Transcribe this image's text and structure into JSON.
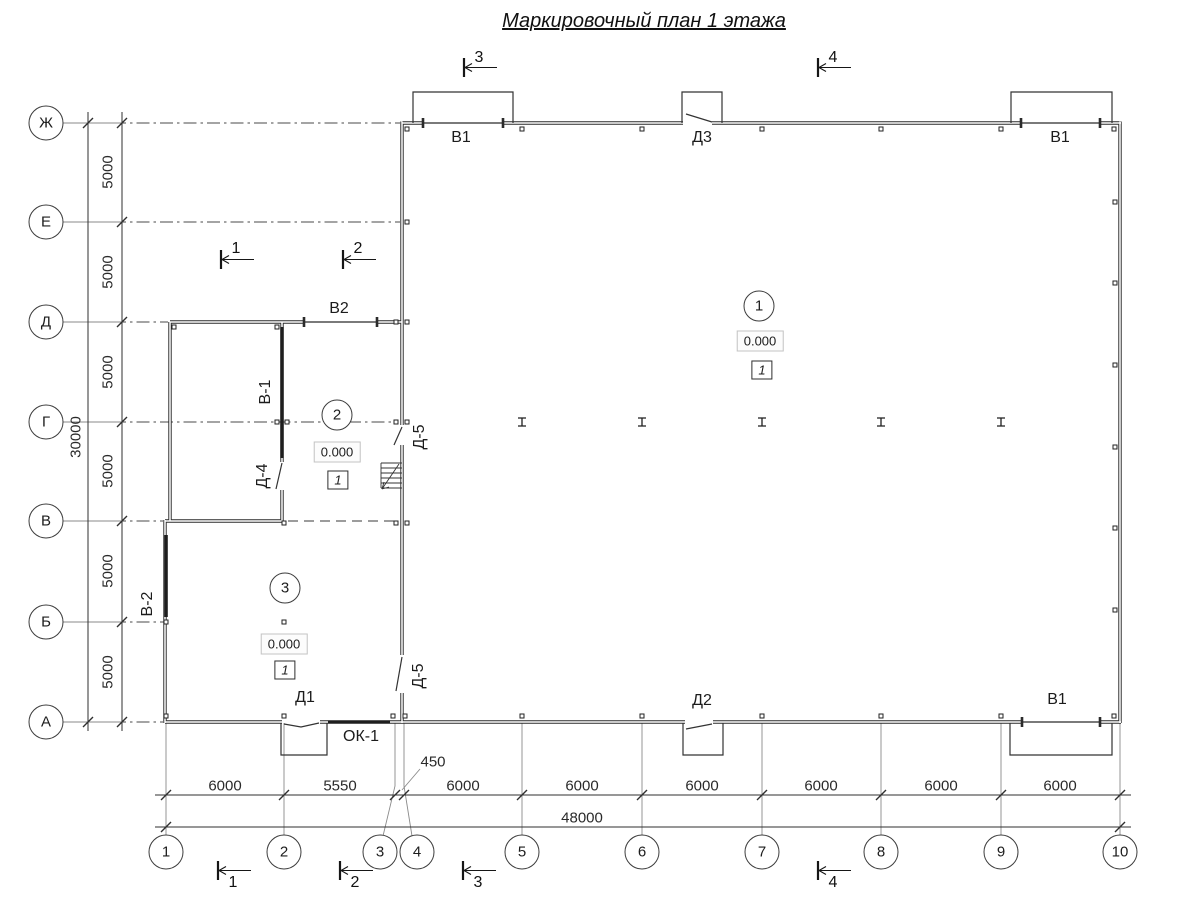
{
  "title": "Маркировочный план 1 этажа",
  "axes": {
    "letters": [
      "Ж",
      "Е",
      "Д",
      "Г",
      "В",
      "Б",
      "А"
    ],
    "numbers": [
      "1",
      "2",
      "3",
      "4",
      "5",
      "6",
      "7",
      "8",
      "9",
      "10"
    ]
  },
  "dimensions": {
    "vertical_bays": [
      "5000",
      "5000",
      "5000",
      "5000",
      "5000",
      "5000"
    ],
    "vertical_total": "30000",
    "horizontal_bays": [
      "6000",
      "5550",
      "450",
      "6000",
      "6000",
      "6000",
      "6000",
      "6000",
      "6000"
    ],
    "horizontal_total": "48000"
  },
  "section_markers": [
    "1",
    "2",
    "3",
    "4"
  ],
  "openings": {
    "gate_top_left": "В1",
    "door_top": "Д3",
    "gate_top_right": "В1",
    "gate_vestibule": "В2",
    "gate_inner": "В-1",
    "door_inner": "Д-4",
    "door_hall_upper": "Д-5",
    "door_hall_lower": "Д-5",
    "gate_left": "В-2",
    "door_bottom_left": "Д1",
    "door_bottom_mid": "Д2",
    "window_bottom": "ОК-1",
    "gate_bottom_right": "В1"
  },
  "rooms": [
    {
      "number": "1",
      "elevation": "0.000",
      "finish_type": "1"
    },
    {
      "number": "2",
      "elevation": "0.000",
      "finish_type": "1"
    },
    {
      "number": "3",
      "elevation": "0.000",
      "finish_type": "1"
    }
  ],
  "colors": {
    "wall": "#2b2b2b",
    "grid_line": "#4a4a4a",
    "dimension_line": "#2f2f2f",
    "extension_line": "#8a8a8a",
    "background": "#ffffff"
  }
}
